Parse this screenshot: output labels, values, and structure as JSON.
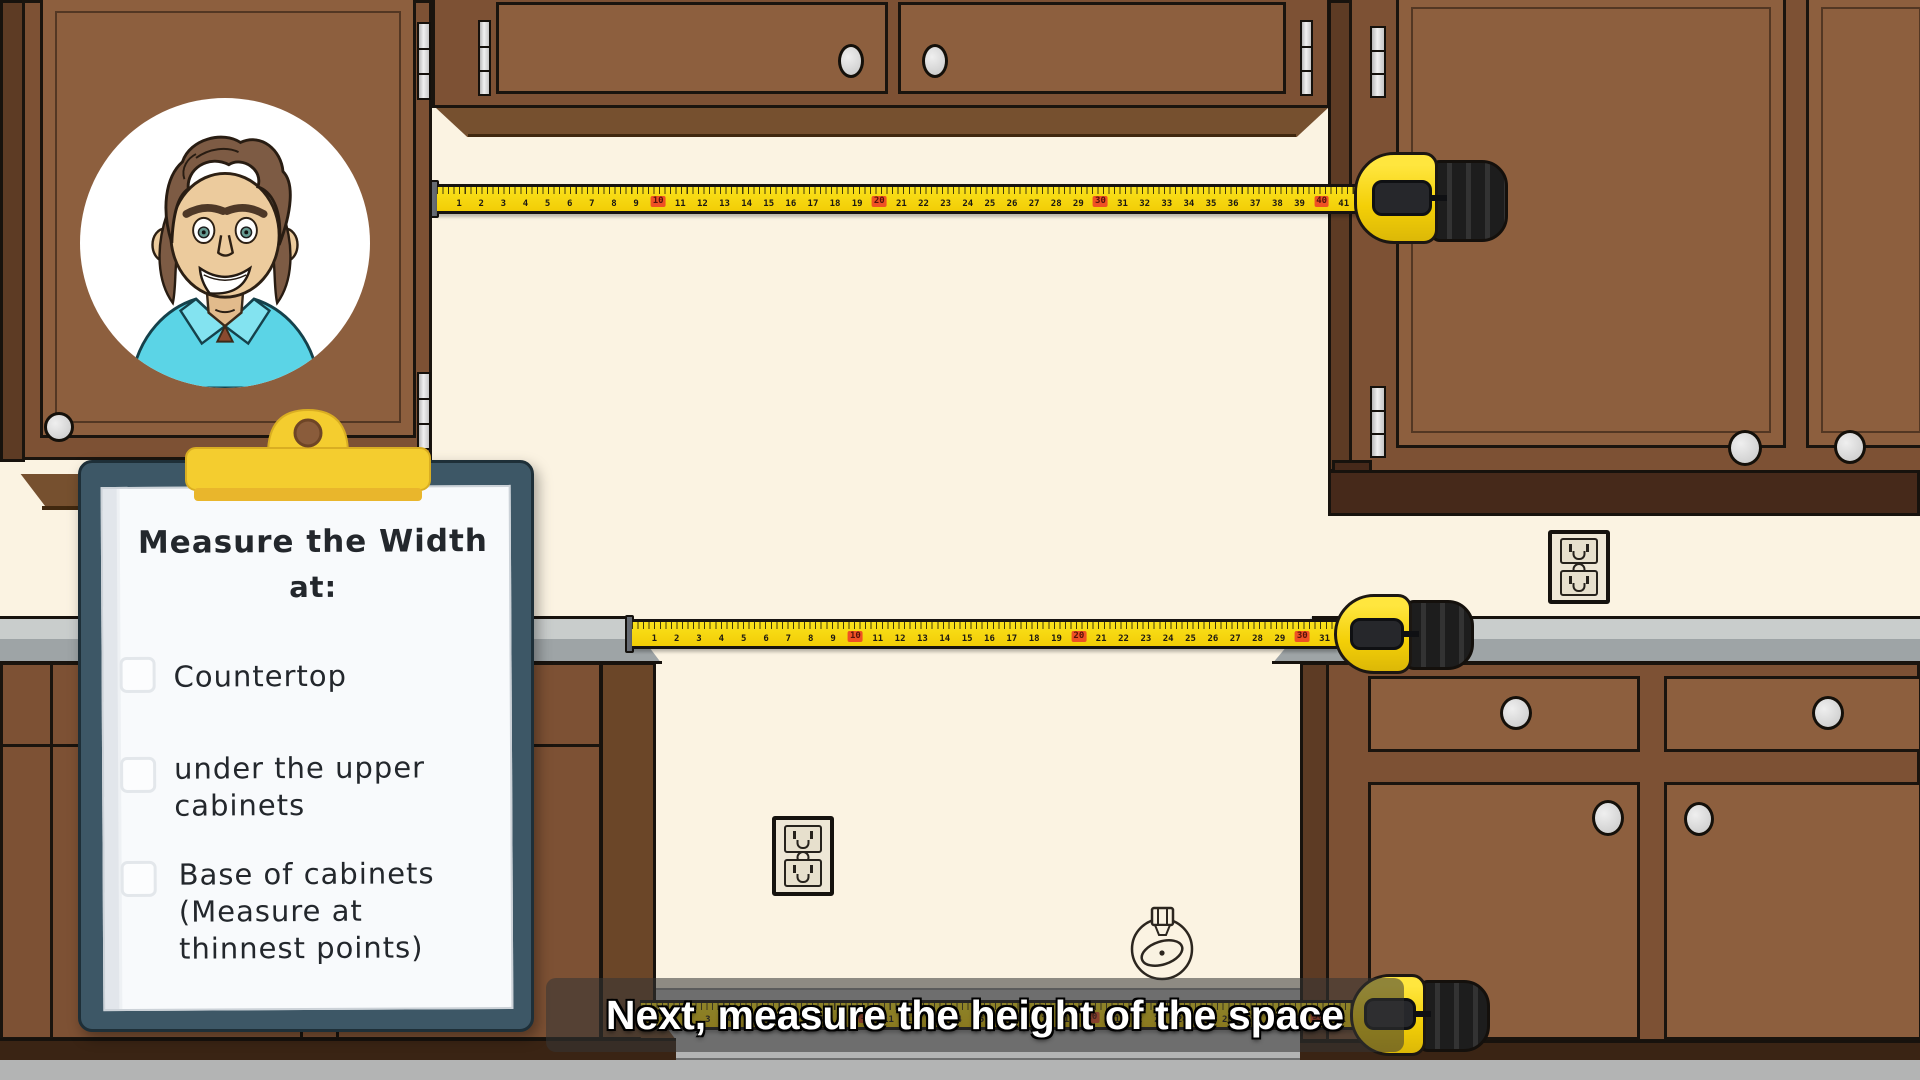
{
  "scene": {
    "type": "animated kitchen measuring tutorial frame",
    "wall_color": "#fbf3e2",
    "cabinet_color": "#8d5f3e",
    "counter_color": "#c9cdcc",
    "floor_color": "#b3b4b4",
    "tape_yellow": "#f2cd06",
    "tape_highlight_red": "#ef5024",
    "clipboard_board_color": "#3d5766",
    "clip_color": "#f4cd2f",
    "avatar": "cartoon man with wavy brown hair, green eyes and a cyan collared shirt in a white circle"
  },
  "clipboard": {
    "title_line1": "Measure the Width",
    "title_line2": "at:",
    "items": [
      {
        "label": "Countertop",
        "checked": false
      },
      {
        "label": "under the upper cabinets",
        "checked": false
      },
      {
        "label": "Base of cabinets (Measure at thinnest points)",
        "checked": false
      }
    ]
  },
  "caption": {
    "text": "Next, measure the height of the space"
  },
  "tapes": {
    "top": {
      "min": 1,
      "max": 41,
      "red_every": 10
    },
    "middle": {
      "min": 1,
      "max": 31,
      "red_every": 10
    },
    "bottom": {
      "min": 1,
      "max": 31,
      "red_every": 10
    }
  }
}
